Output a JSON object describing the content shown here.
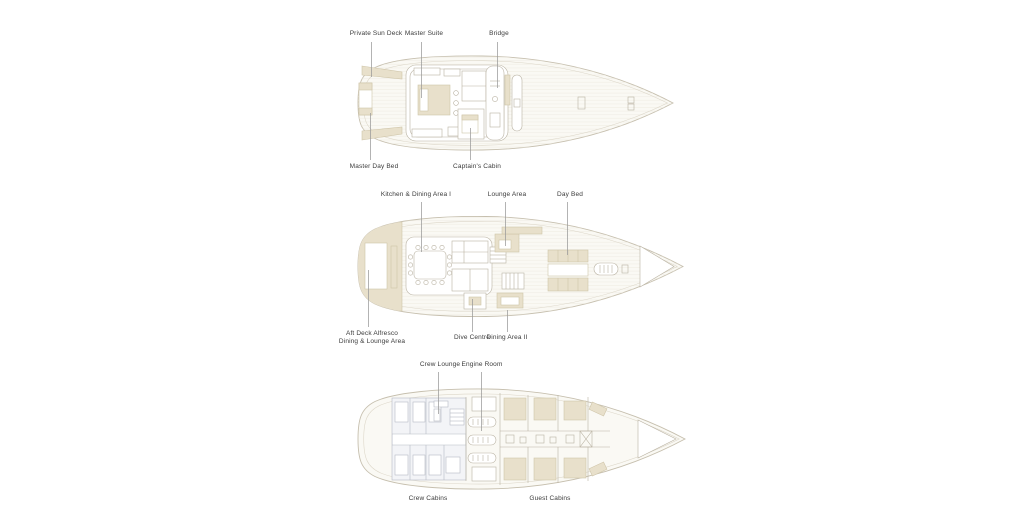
{
  "colors": {
    "background": "#ffffff",
    "deck_fill": "#faf9f4",
    "hull_outline": "#c6bfae",
    "inner_line": "#dcd6c8",
    "plank_line": "#edeae1",
    "interior_line": "#b9b2a2",
    "beige_fill": "#e8e0cb",
    "beige_stroke": "#cfc5a9",
    "crew_line": "#b6bac3",
    "crew_fill": "#f3f4f7",
    "label_text": "#3b3b3b",
    "leader_line": "#9a9a9a"
  },
  "decks": {
    "upper": {
      "labels": {
        "private_sun_deck": "Private Sun Deck",
        "master_suite": "Master Suite",
        "bridge": "Bridge",
        "master_day_bed": "Master Day Bed",
        "captains_cabin": "Captain's Cabin"
      }
    },
    "main": {
      "labels": {
        "kitchen_dining_1": "Kitchen & Dining Area I",
        "lounge_area": "Lounge Area",
        "day_bed": "Day Bed",
        "aft_deck_line1": "Aft Deck Alfresco",
        "aft_deck_line2": "Dining & Lounge Area",
        "dive_centre": "Dive Centre",
        "dining_area_2": "Dining Area II"
      }
    },
    "lower": {
      "labels": {
        "crew_lounge": "Crew Lounge",
        "engine_room": "Engine Room",
        "crew_cabins": "Crew Cabins",
        "guest_cabins": "Guest Cabins"
      }
    }
  }
}
